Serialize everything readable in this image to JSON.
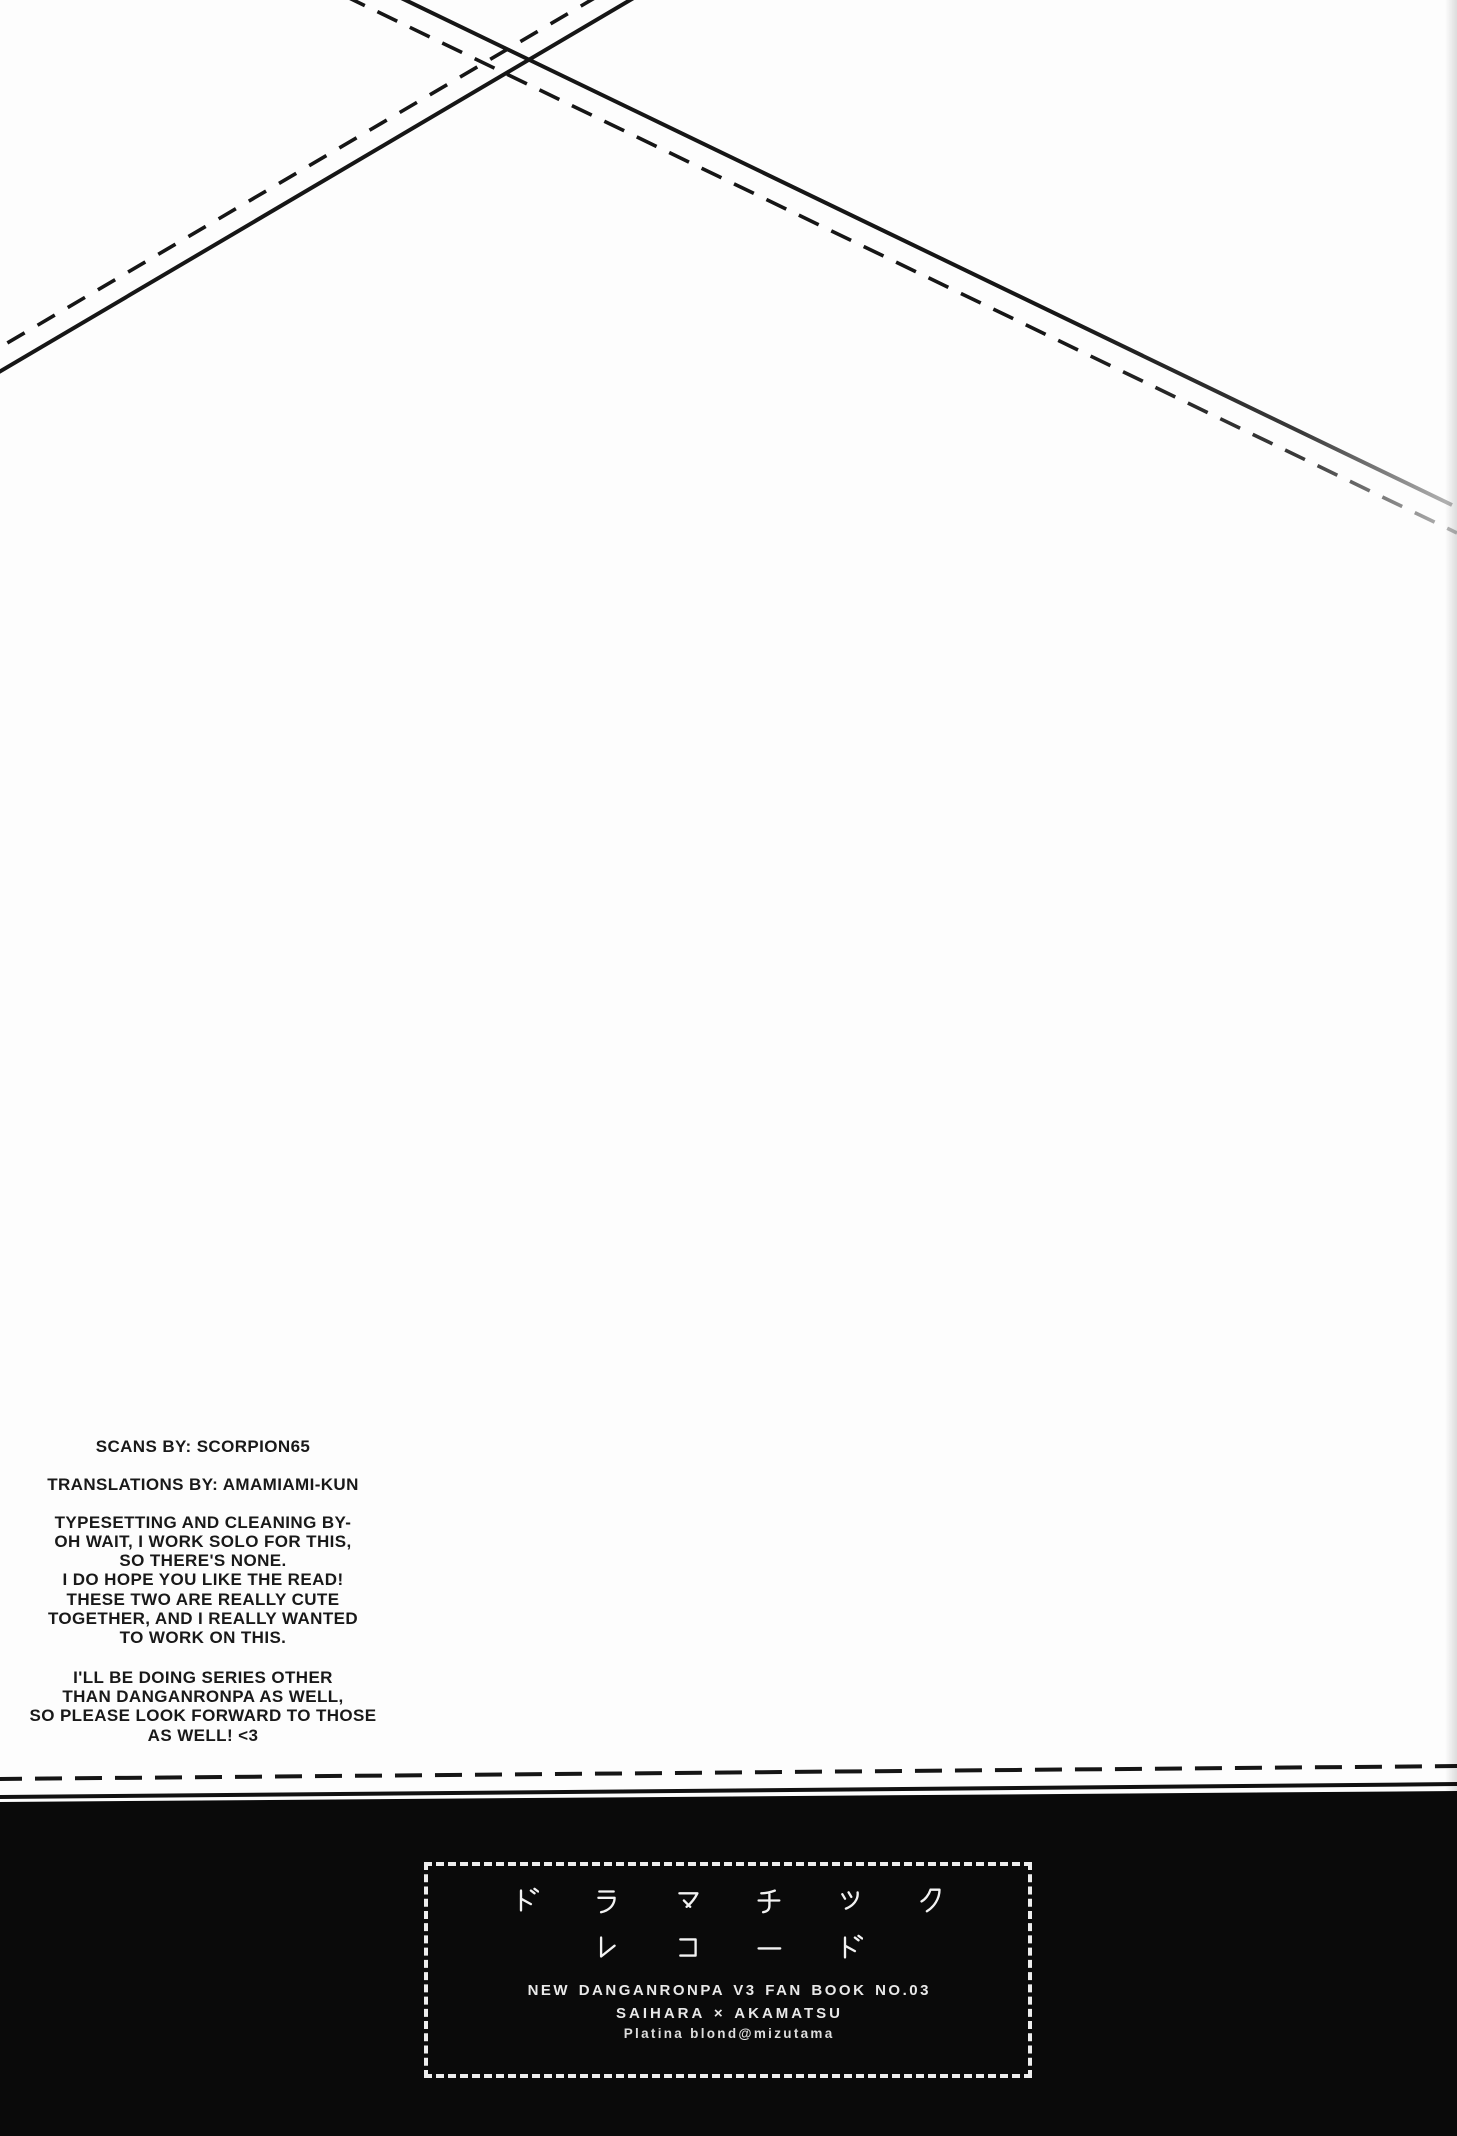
{
  "page": {
    "kind": "scanned doujinshi credits page",
    "colors": {
      "paper": "#fdfdfd",
      "ink": "#161616",
      "footer_background": "#0a0a0a",
      "footer_text": "#f0f0f0",
      "box_border": "#ededed"
    }
  },
  "credits": {
    "paragraphs": [
      {
        "lines": [
          "SCANS BY: SCORPION65"
        ]
      },
      {
        "lines": [
          "TRANSLATIONS BY: AMAMIAMI-KUN"
        ]
      },
      {
        "lines": [
          "TYPESETTING AND CLEANING BY-",
          "OH WAIT, I WORK SOLO FOR THIS,",
          "SO THERE'S NONE.",
          "I DO HOPE YOU LIKE THE READ!",
          "THESE TWO ARE REALLY CUTE",
          "TOGETHER, AND I REALLY WANTED",
          "TO WORK ON THIS."
        ]
      },
      {
        "lines": [
          "I'LL BE DOING SERIES OTHER",
          "THAN DANGANRONPA AS WELL,",
          "SO PLEASE LOOK FORWARD TO THOSE",
          "AS WELL! <3"
        ]
      }
    ]
  },
  "footer": {
    "title_jp_line1": "ドラマチック",
    "title_jp_line2": "レコード",
    "book_info": "NEW DANGANRONPA V3 FAN BOOK NO.03",
    "pairing": "SAIHARA × AKAMATSU",
    "circle_credit": "Platina blond@mizutama"
  }
}
